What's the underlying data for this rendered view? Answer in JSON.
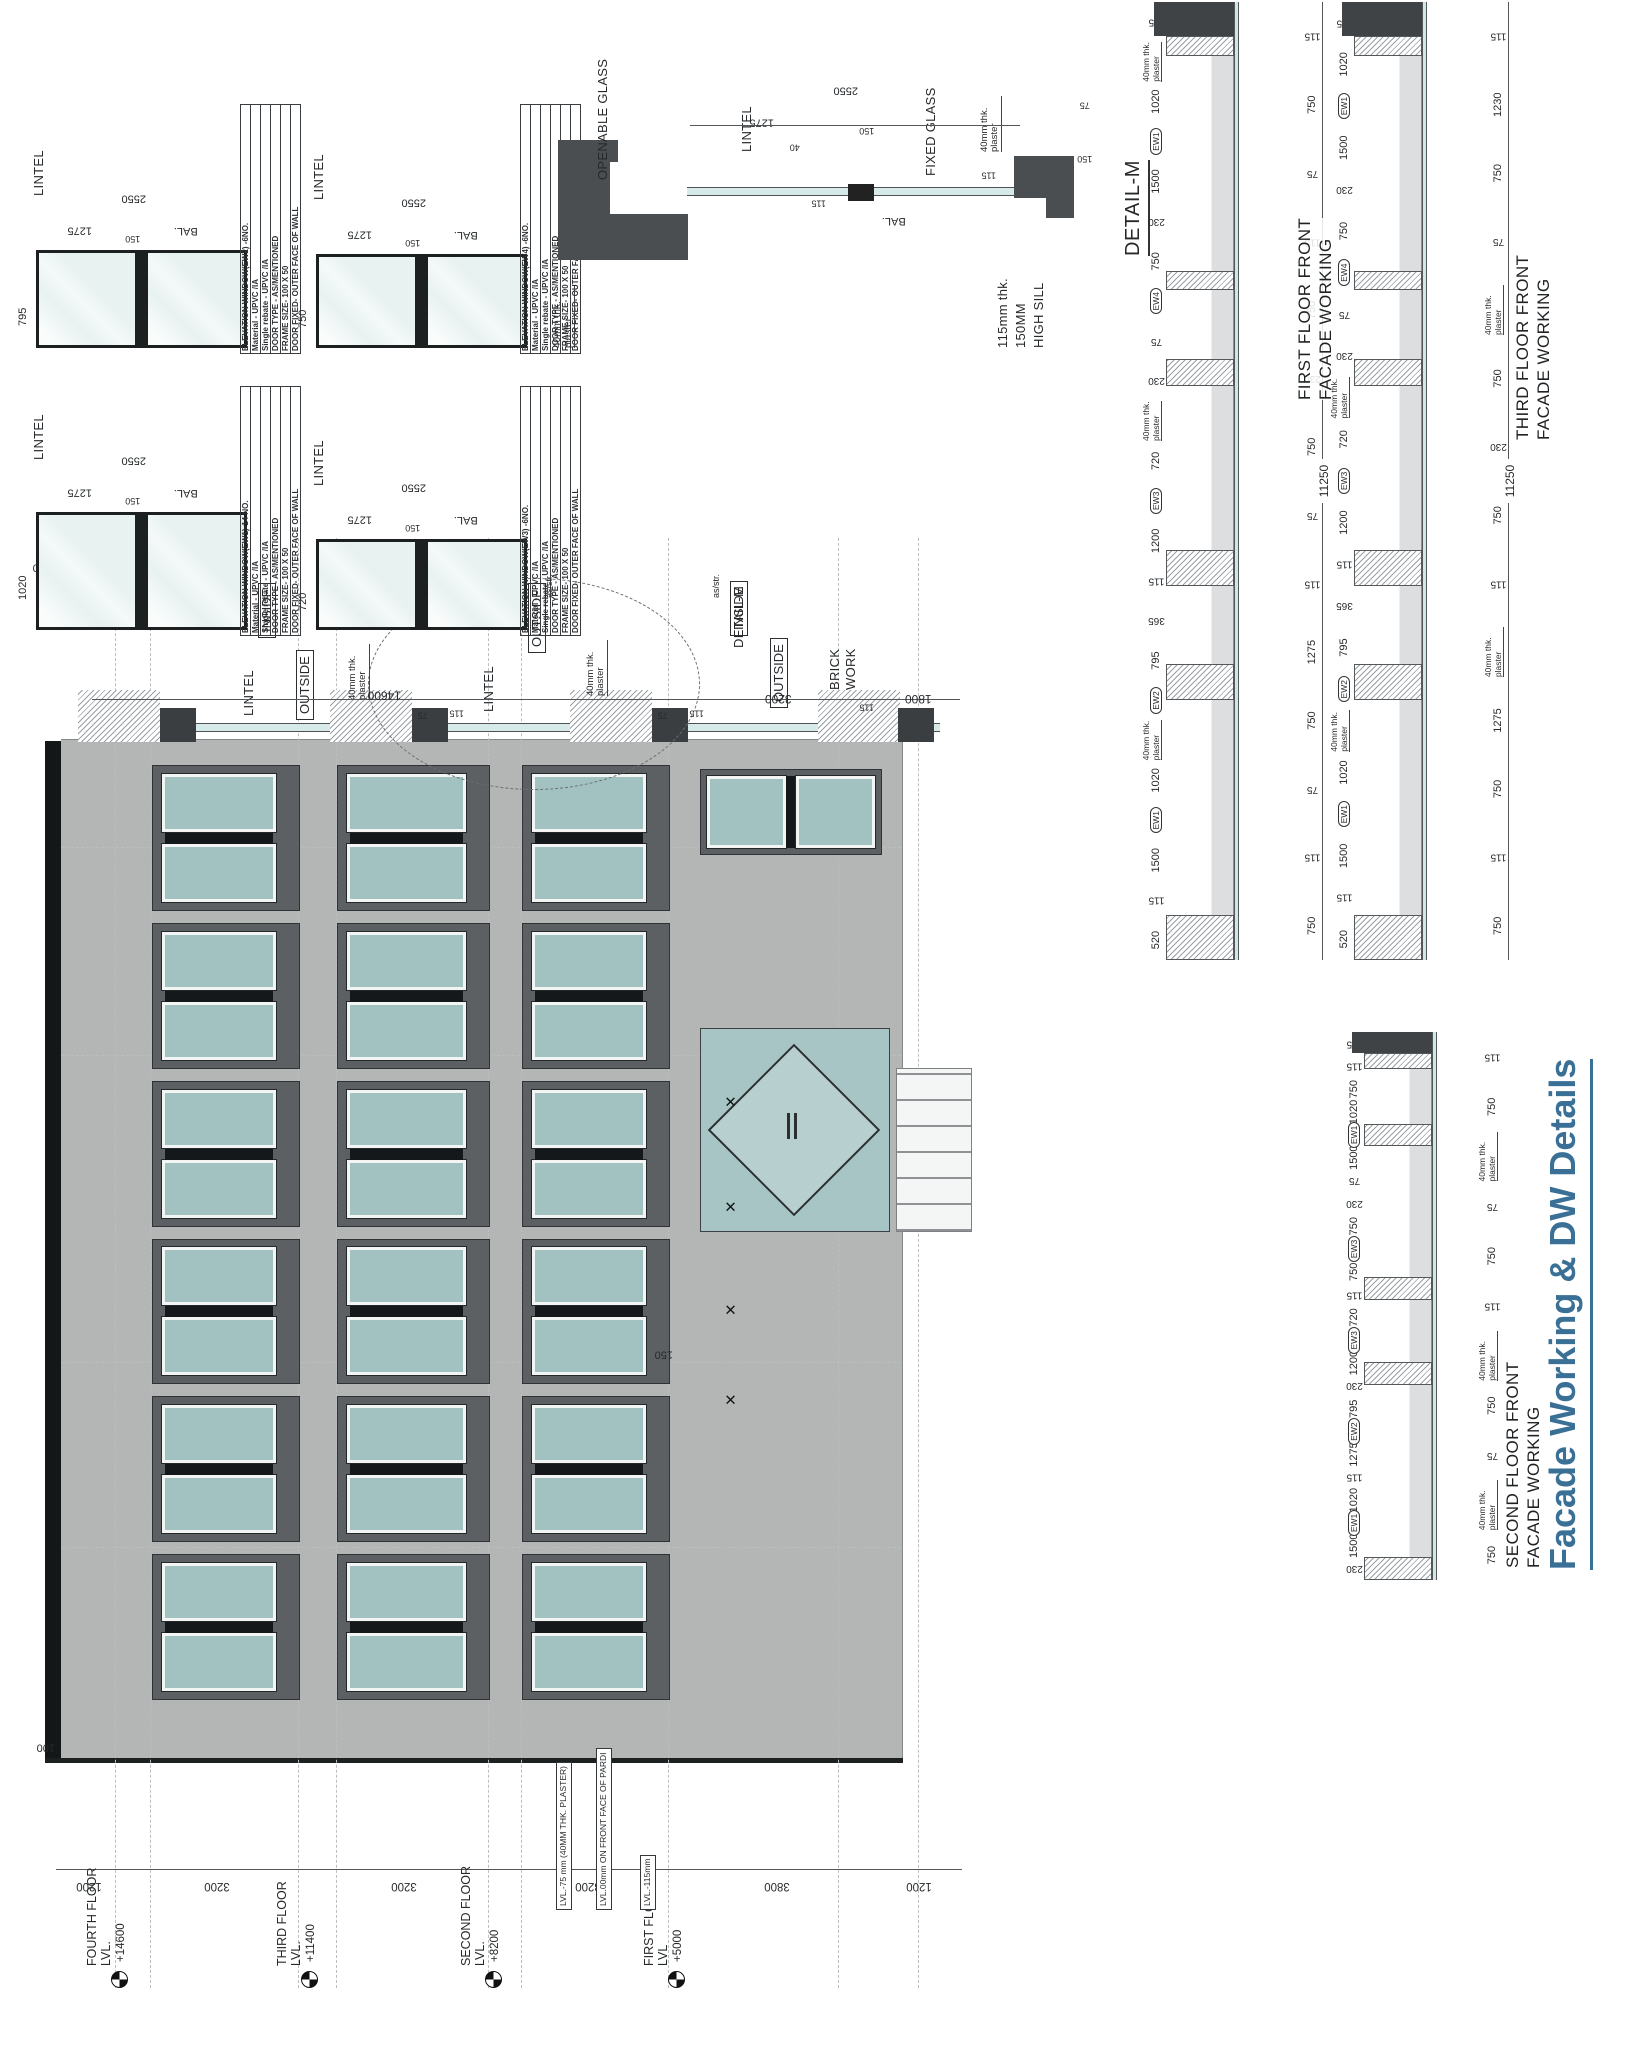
{
  "page_title": {
    "text": "Facade Working & DW Details",
    "color": "#3a7096"
  },
  "colors": {
    "title_blue": "#3a7096",
    "glass_teal": "#a2c2c1",
    "facade_gray": "#b4b6b5",
    "panel_gray": "#5c6062",
    "wall_dark": "#4a4e50",
    "glass_line": "#d6ebe9"
  },
  "ew_common": {
    "rows": [
      "Material  -  UPVC /IA",
      "Single rebate - UPVC /IA",
      "DOOR TYPE - AS/MENTIONED",
      "FRAME SIZE- 100 X 50",
      "DOOR FIXED- OUTER FACE OF WALL"
    ],
    "dims": {
      "half": "1275",
      "mullion": "150",
      "overall": "2550"
    },
    "labels": {
      "lintel": "LINTEL",
      "bal": "BAL."
    }
  },
  "ew_units": [
    {
      "tag": "EW2",
      "header": "ELEVATION WINDOW(EW2)  -6NO.",
      "height": "795"
    },
    {
      "tag": "EW1",
      "header": "ELEVATION WINDOW(EW1)-14 NO.",
      "height": "1020"
    },
    {
      "tag": "EW4",
      "header": "ELEVATION WINDOW(EW4)  -6NO.",
      "height": "750"
    },
    {
      "tag": "EW3",
      "header": "ELEVATION WINDOW(EW3)  -6NO.",
      "height": "720"
    }
  ],
  "detail_m": {
    "title": "DETAIL-M",
    "plaster_top": "40mm thk. plaster",
    "plaster_right": "40mm thk. plaster",
    "openable": "OPENABLE GLASS",
    "fixed": "FIXED GLASS",
    "lintel": "LINTEL",
    "bal": "BAL.",
    "sill1": "115mm thk.",
    "sill2": "150MM",
    "sill3": "HIGH SILL",
    "d40": "40",
    "d115a": "115",
    "d115b": "115",
    "d1275": "1275",
    "d150": "150",
    "d2550": "2550",
    "d75": "75",
    "d150b": "150"
  },
  "plan": {
    "outside": "OUTSIDE",
    "inside": "INSIDE",
    "lintel": "LINTEL",
    "plaster": "40mm thk. plaster",
    "detailm": "DETAIL-M",
    "brick1": "BRICK",
    "brick2": "WORK",
    "asstr": "as/str.",
    "d230": "230",
    "d60": "60",
    "d100": "100",
    "d1200": "1200",
    "d75a": "75",
    "d115a": "115",
    "d75b": "75",
    "d115b": "115",
    "d115c": "115",
    "overall1": "14600",
    "overall2": "3200",
    "overall3": "1800"
  },
  "elevation": {
    "levels": [
      {
        "name": "FOURTH FLOOR LVL.",
        "value": "+14600",
        "top": 85
      },
      {
        "name": "THIRD FLOOR LVL.",
        "value": "+11400",
        "top": 275
      },
      {
        "name": "SECOND FLOOR LVL.",
        "value": "+8200",
        "top": 459
      },
      {
        "name": "FIRST FLOOR LVL",
        "value": "+5000",
        "top": 642
      }
    ],
    "height_dims": [
      {
        "x": "1200",
        "h": 66
      },
      {
        "x": "3200",
        "h": 190
      },
      {
        "x": "3200",
        "h": 184
      },
      {
        "x": "3200",
        "h": 183
      },
      {
        "x": "3800",
        "h": 196
      },
      {
        "x": "1200",
        "h": 87
      }
    ],
    "notes": [
      {
        "text": "LVL.-75 mm (40MM THK. PLASTER)",
        "top": 556,
        "w": 96
      },
      {
        "text": "LVL.00mm ON FRONT FACE OF PARDI",
        "top": 596,
        "w": 110
      },
      {
        "text": "LVL.-115mm",
        "top": 640,
        "w": 62
      }
    ],
    "d150": "150",
    "d100": "100",
    "bands": [
      {
        "top": 112,
        "h": 148
      },
      {
        "top": 297,
        "h": 153
      },
      {
        "top": 482,
        "h": 148
      }
    ],
    "bays": [
      {},
      {},
      {},
      {},
      {},
      {}
    ],
    "xmarks": [
      {
        "left": 462
      },
      {
        "left": 552
      },
      {
        "left": 655
      },
      {
        "left": 760
      }
    ]
  },
  "strips": [
    {
      "title1": "FIRST FLOOR FRONT",
      "title2": "FACADE WORKING",
      "overall": "11250",
      "dims_inner": [
        {
          "c": "dv",
          "x": "520"
        },
        {
          "c": "dr",
          "x": "115"
        },
        {
          "c": "dv",
          "x": "1500"
        },
        {
          "c": "tag",
          "x": "EW1"
        },
        {
          "c": "dv",
          "x": "1020"
        },
        {
          "c": "note",
          "x": "40mm thk. plaster"
        },
        {
          "c": "tag",
          "x": "EW2"
        },
        {
          "c": "dv",
          "x": "795"
        },
        {
          "c": "dr",
          "x": "365"
        },
        {
          "c": "dr",
          "x": "115"
        },
        {
          "c": "dv",
          "x": "1200"
        },
        {
          "c": "tag",
          "x": "EW3"
        },
        {
          "c": "dv",
          "x": "720"
        },
        {
          "c": "note",
          "x": "40mm thk. plaster"
        },
        {
          "c": "dr",
          "x": "230"
        },
        {
          "c": "dr",
          "x": "75"
        },
        {
          "c": "tag",
          "x": "EW4"
        },
        {
          "c": "dv",
          "x": "750"
        },
        {
          "c": "dr",
          "x": "230"
        },
        {
          "c": "dv",
          "x": "1500"
        },
        {
          "c": "tag",
          "x": "EW1"
        },
        {
          "c": "dv",
          "x": "1020"
        },
        {
          "c": "note",
          "x": "40mm thk. plaster"
        },
        {
          "c": "dr",
          "x": "115"
        }
      ],
      "dims_outer": [
        {
          "c": "dv",
          "x": "750"
        },
        {
          "c": "dr",
          "x": "115"
        },
        {
          "c": "dr",
          "x": "75"
        },
        {
          "c": "dv",
          "x": "750"
        },
        {
          "c": "dv",
          "x": "1275"
        },
        {
          "c": "dr",
          "x": "115"
        },
        {
          "c": "dr",
          "x": "75"
        },
        {
          "c": "dv",
          "x": "750"
        },
        {
          "c": "dr",
          "x": "230"
        },
        {
          "c": "dv",
          "x": "750"
        },
        {
          "c": "dr",
          "x": "115"
        },
        {
          "c": "dr",
          "x": "75"
        },
        {
          "c": "dv",
          "x": "750"
        },
        {
          "c": "dr",
          "x": "115"
        }
      ],
      "wall": [
        {
          "c": "sw",
          "f": "5"
        },
        {
          "c": "so",
          "f": "25"
        },
        {
          "c": "sw",
          "f": "4"
        },
        {
          "c": "so",
          "f": "9"
        },
        {
          "c": "sw",
          "f": "4"
        },
        {
          "c": "so",
          "f": "19"
        },
        {
          "c": "sw",
          "f": "3"
        },
        {
          "c": "so",
          "f": "8"
        },
        {
          "c": "sw",
          "f": "2"
        },
        {
          "c": "so",
          "f": "25"
        },
        {
          "c": "sw",
          "f": "2"
        },
        {
          "c": "sp",
          "f": "4"
        }
      ]
    },
    {
      "title1": "SECOND FLOOR FRONT",
      "title2": "FACADE WORKING",
      "overall": "11250",
      "dims_inner": [
        {
          "c": "dr",
          "x": "230"
        },
        {
          "c": "dv",
          "x": "1500"
        },
        {
          "c": "tag",
          "x": "EW1"
        },
        {
          "c": "dv",
          "x": "1020"
        },
        {
          "c": "dr",
          "x": "115"
        },
        {
          "c": "dv",
          "x": "1275"
        },
        {
          "c": "tag",
          "x": "EW2"
        },
        {
          "c": "dv",
          "x": "795"
        },
        {
          "c": "dr",
          "x": "230"
        },
        {
          "c": "dv",
          "x": "1200"
        },
        {
          "c": "tag",
          "x": "EW3"
        },
        {
          "c": "dv",
          "x": "720"
        },
        {
          "c": "dr",
          "x": "115"
        },
        {
          "c": "dv",
          "x": "750"
        },
        {
          "c": "tag",
          "x": "EW3"
        },
        {
          "c": "dv",
          "x": "750"
        },
        {
          "c": "dr",
          "x": "230"
        },
        {
          "c": "dr",
          "x": "75"
        },
        {
          "c": "dv",
          "x": "1500"
        },
        {
          "c": "tag",
          "x": "EW1"
        },
        {
          "c": "dv",
          "x": "1020"
        },
        {
          "c": "dv",
          "x": "750"
        },
        {
          "c": "dr",
          "x": "115"
        },
        {
          "c": "dr",
          "x": "115"
        }
      ],
      "dims_outer": [
        {
          "c": "dv",
          "x": "750"
        },
        {
          "c": "note",
          "x": "40mm thk. plaster"
        },
        {
          "c": "dr",
          "x": "75"
        },
        {
          "c": "dv",
          "x": "750"
        },
        {
          "c": "note",
          "x": "40mm thk. plaster"
        },
        {
          "c": "dr",
          "x": "115"
        },
        {
          "c": "dv",
          "x": "750"
        },
        {
          "c": "dr",
          "x": "75"
        },
        {
          "c": "note",
          "x": "40mm thk. plaster"
        },
        {
          "c": "dv",
          "x": "750"
        },
        {
          "c": "dr",
          "x": "115"
        }
      ],
      "wall": [
        {
          "c": "sw",
          "f": "3"
        },
        {
          "c": "so",
          "f": "25"
        },
        {
          "c": "sw",
          "f": "3"
        },
        {
          "c": "so",
          "f": "9"
        },
        {
          "c": "sw",
          "f": "3"
        },
        {
          "c": "so",
          "f": "19"
        },
        {
          "c": "sw",
          "f": "3"
        },
        {
          "c": "so",
          "f": "8"
        },
        {
          "c": "sw",
          "f": "2"
        },
        {
          "c": "sp",
          "f": "3"
        }
      ]
    },
    {
      "title1": "THIRD FLOOR FRONT",
      "title2": "FACADE WORKING",
      "overall": "11250",
      "dims_inner": [
        {
          "c": "dv",
          "x": "520"
        },
        {
          "c": "dr",
          "x": "115"
        },
        {
          "c": "dv",
          "x": "1500"
        },
        {
          "c": "tag",
          "x": "EW1"
        },
        {
          "c": "dv",
          "x": "1020"
        },
        {
          "c": "note",
          "x": "40mm thk. plaster"
        },
        {
          "c": "tag",
          "x": "EW2"
        },
        {
          "c": "dv",
          "x": "795"
        },
        {
          "c": "dr",
          "x": "365"
        },
        {
          "c": "dr",
          "x": "115"
        },
        {
          "c": "dv",
          "x": "1200"
        },
        {
          "c": "tag",
          "x": "EW3"
        },
        {
          "c": "dv",
          "x": "720"
        },
        {
          "c": "note",
          "x": "40mm thk. plaster"
        },
        {
          "c": "dr",
          "x": "230"
        },
        {
          "c": "dr",
          "x": "75"
        },
        {
          "c": "tag",
          "x": "EW4"
        },
        {
          "c": "dv",
          "x": "750"
        },
        {
          "c": "dr",
          "x": "230"
        },
        {
          "c": "dv",
          "x": "1500"
        },
        {
          "c": "tag",
          "x": "EW1"
        },
        {
          "c": "dv",
          "x": "1020"
        },
        {
          "c": "dr",
          "x": "115"
        }
      ],
      "dims_outer": [
        {
          "c": "dv",
          "x": "750"
        },
        {
          "c": "dr",
          "x": "115"
        },
        {
          "c": "dv",
          "x": "750"
        },
        {
          "c": "dv",
          "x": "1275"
        },
        {
          "c": "note",
          "x": "40mm thk. plaster"
        },
        {
          "c": "dr",
          "x": "115"
        },
        {
          "c": "dv",
          "x": "750"
        },
        {
          "c": "dr",
          "x": "230"
        },
        {
          "c": "dv",
          "x": "750"
        },
        {
          "c": "note",
          "x": "40mm thk. plaster"
        },
        {
          "c": "dr",
          "x": "75"
        },
        {
          "c": "dv",
          "x": "750"
        },
        {
          "c": "dv",
          "x": "1230"
        },
        {
          "c": "dr",
          "x": "115"
        }
      ],
      "wall": [
        {
          "c": "sw",
          "f": "5"
        },
        {
          "c": "so",
          "f": "25"
        },
        {
          "c": "sw",
          "f": "4"
        },
        {
          "c": "so",
          "f": "9"
        },
        {
          "c": "sw",
          "f": "4"
        },
        {
          "c": "so",
          "f": "19"
        },
        {
          "c": "sw",
          "f": "3"
        },
        {
          "c": "so",
          "f": "8"
        },
        {
          "c": "sw",
          "f": "2"
        },
        {
          "c": "so",
          "f": "25"
        },
        {
          "c": "sw",
          "f": "2"
        },
        {
          "c": "sp",
          "f": "4"
        }
      ]
    }
  ]
}
